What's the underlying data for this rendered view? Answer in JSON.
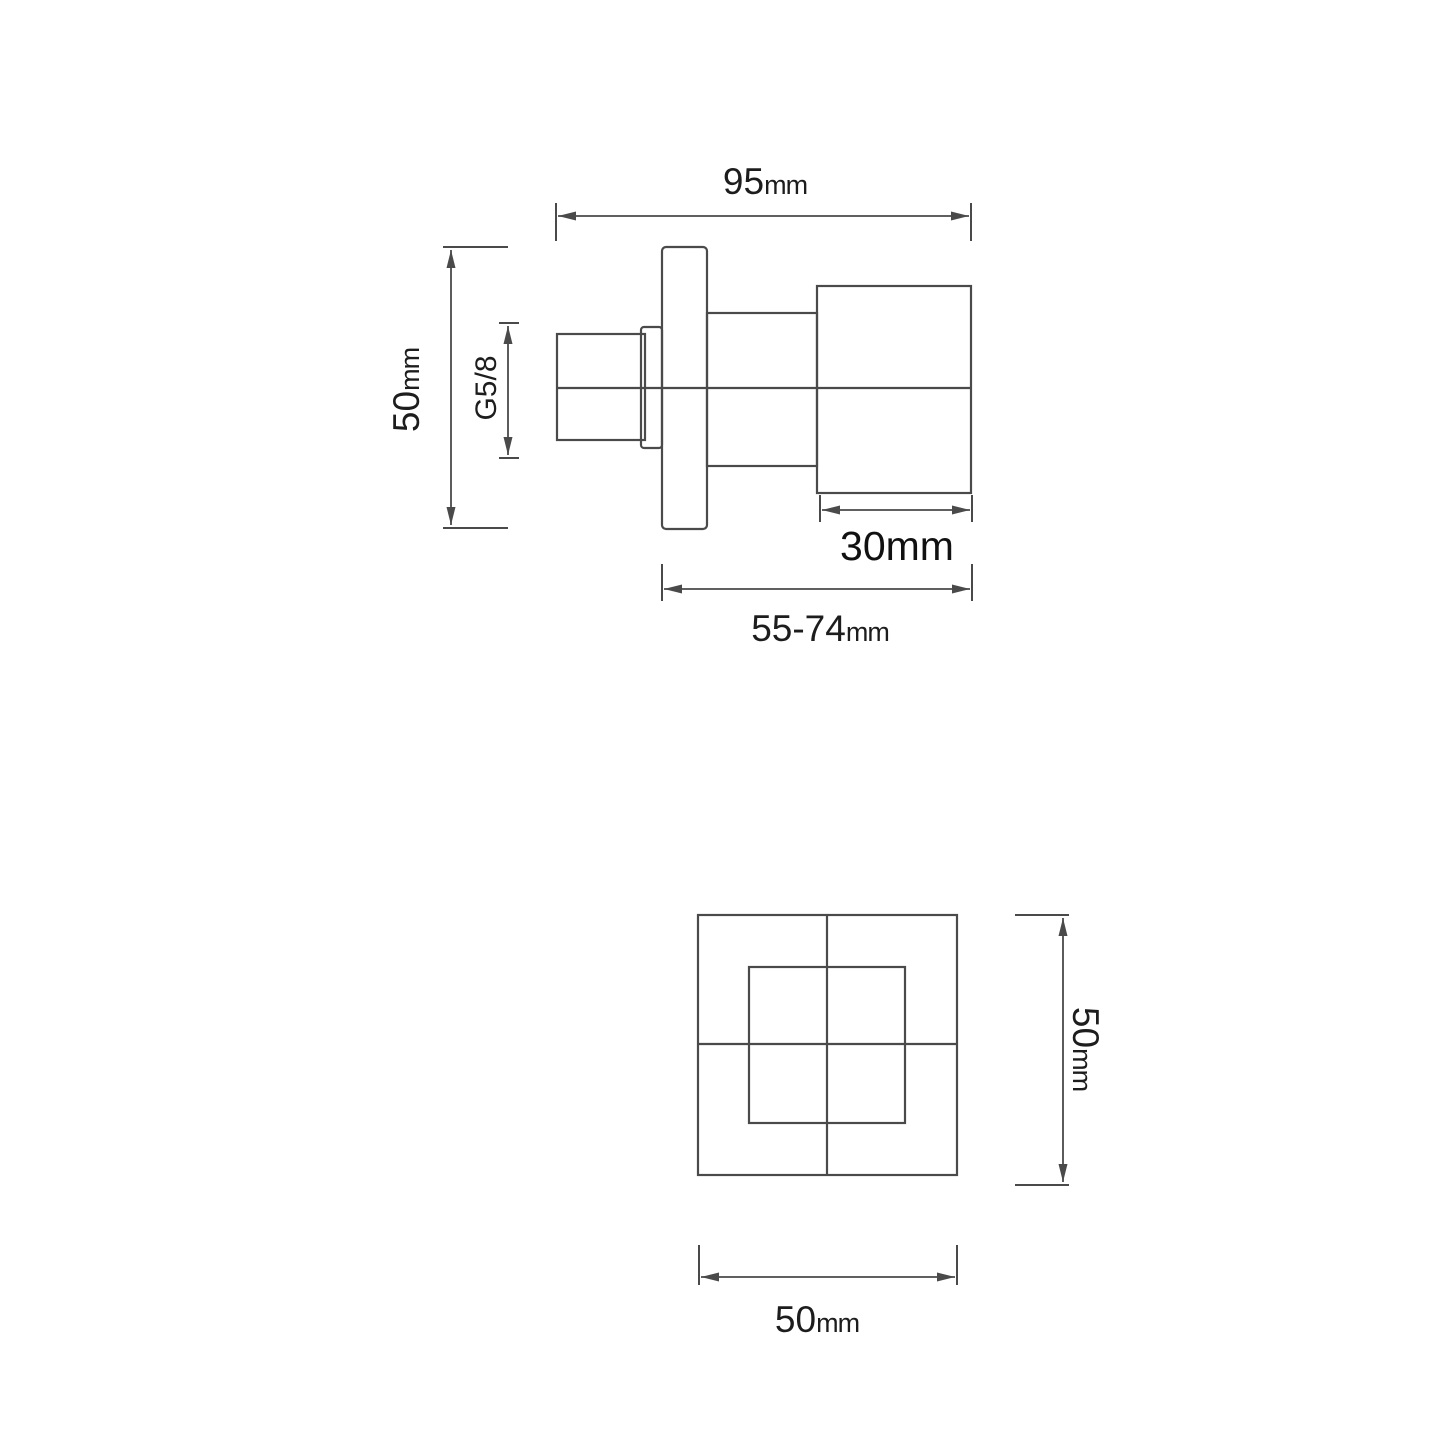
{
  "labels": {
    "side_view": {
      "overall_width": {
        "value": "95",
        "unit": "mm"
      },
      "flange_height": {
        "value": "50",
        "unit": "mm"
      },
      "thread": "G5/8",
      "handle_depth": "30mm",
      "install_depth": {
        "value": "55-74",
        "unit": "mm"
      }
    },
    "front_view": {
      "plate_height": {
        "value": "50",
        "unit": "mm"
      },
      "plate_width": {
        "value": "50",
        "unit": "mm"
      }
    }
  },
  "colors": {
    "background": "#ffffff",
    "line": "#4a4a4a",
    "text": "#1d1d1d",
    "text_strong": "#111111"
  }
}
